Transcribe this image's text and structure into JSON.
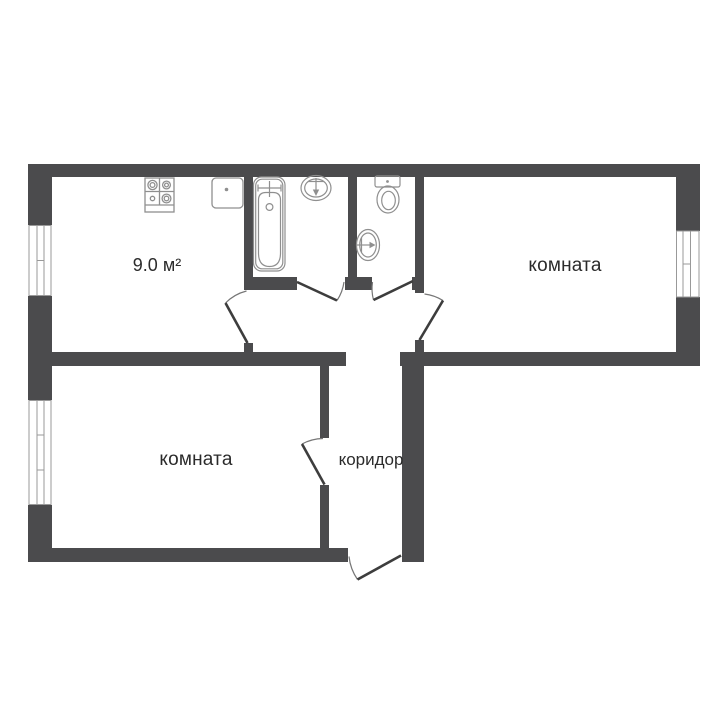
{
  "plan": {
    "type": "apartment-floor-plan",
    "labels": {
      "kitchen_area": "9.0 м²",
      "room_right": "комната",
      "room_bottom": "комната",
      "corridor": "коридор"
    },
    "rooms": [
      {
        "id": "kitchen",
        "text": "9.0 м²"
      },
      {
        "id": "bathroom",
        "text": ""
      },
      {
        "id": "toilet",
        "text": ""
      },
      {
        "id": "room-right",
        "text": "комната"
      },
      {
        "id": "room-bottom",
        "text": "комната"
      },
      {
        "id": "corridor",
        "text": "коридор"
      }
    ],
    "fixtures": [
      "stove-icon",
      "kitchen-sink-icon",
      "bathtub-icon",
      "washbasin-icon",
      "toilet-icon",
      "round-sink-icon"
    ],
    "windows_count": 3,
    "doors_count": 6,
    "colors": {
      "wall": "#4b4b4d",
      "fixture_line": "#8f8f8f",
      "door_leaf": "#3d3d3d",
      "door_arc": "#767676",
      "window_frame": "#999999",
      "label": "#2b2b2b",
      "background": "#ffffff"
    }
  }
}
